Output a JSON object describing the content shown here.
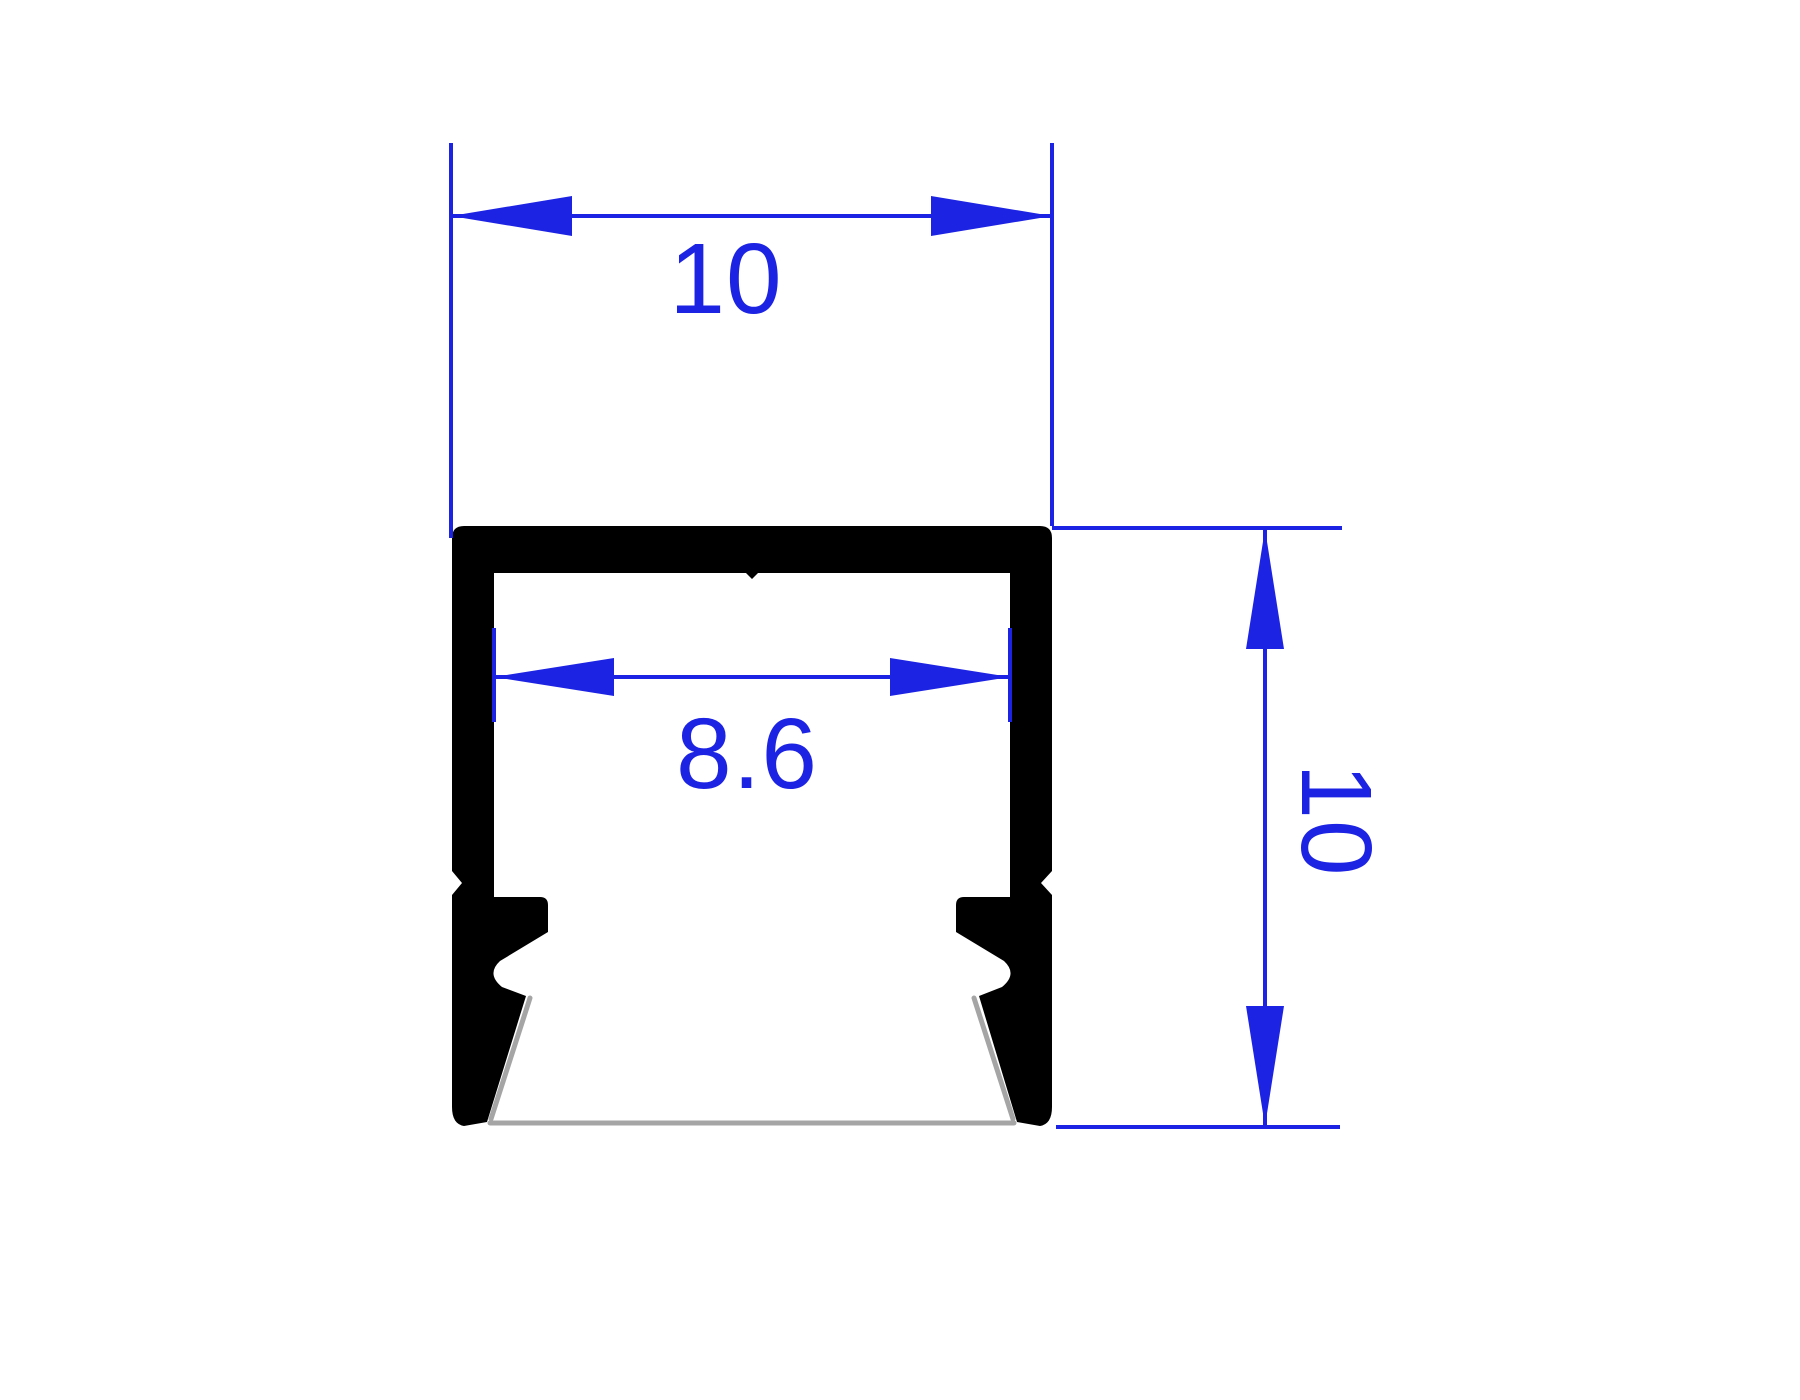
{
  "drawing": {
    "labels": {
      "top_width": "10",
      "inner_width": "8.6",
      "side_height": "10"
    },
    "colors": {
      "dimension": "#1d23e3",
      "profile": "#000000",
      "shadow": "#a5a5a5",
      "background": "#ffffff"
    }
  }
}
